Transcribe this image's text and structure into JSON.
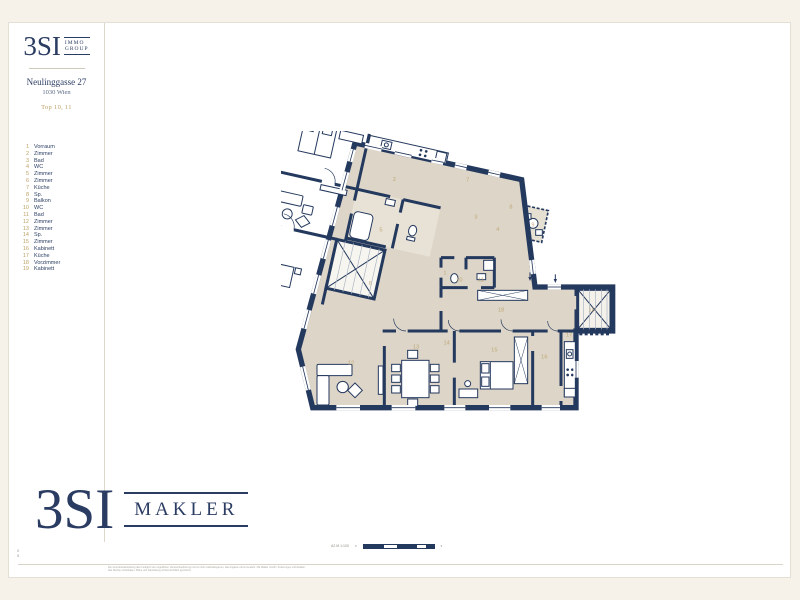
{
  "colors": {
    "navy": "#24395e",
    "gold": "#bda164",
    "beige": "#ddd5c7",
    "cream": "#f6f2e9"
  },
  "header": {
    "logo_text": "3SI",
    "logo_badge_line1": "IMMO",
    "logo_badge_line2": "GROUP",
    "address": "Neulinggasse 27",
    "city": "1030 Wien",
    "unit": "Top 10, 11"
  },
  "legend": {
    "items": [
      {
        "n": "1",
        "label": "Vorraum"
      },
      {
        "n": "2",
        "label": "Zimmer"
      },
      {
        "n": "3",
        "label": "Bad"
      },
      {
        "n": "4",
        "label": "WC"
      },
      {
        "n": "5",
        "label": "Zimmer"
      },
      {
        "n": "6",
        "label": "Zimmer"
      },
      {
        "n": "7",
        "label": "Küche"
      },
      {
        "n": "8",
        "label": "Sp."
      },
      {
        "n": "9",
        "label": "Balkon"
      },
      {
        "n": "10",
        "label": "WC"
      },
      {
        "n": "11",
        "label": "Bad"
      },
      {
        "n": "12",
        "label": "Zimmer"
      },
      {
        "n": "13",
        "label": "Zimmer"
      },
      {
        "n": "14",
        "label": "Sp."
      },
      {
        "n": "15",
        "label": "Zimmer"
      },
      {
        "n": "16",
        "label": "Kabinett"
      },
      {
        "n": "17",
        "label": "Küche"
      },
      {
        "n": "18",
        "label": "Vorzimmer"
      },
      {
        "n": "19",
        "label": "Kabinett"
      }
    ]
  },
  "footer": {
    "logo_text": "3SI",
    "logo_sub": "MAKLER",
    "scale_label": "A2  M 1:100",
    "scale_start": "0",
    "scale_end": "5",
    "fold_mark_top": "0",
    "fold_mark_bottom": "5",
    "disclaimer_line1": "Die Grundrissdarstellung dient lediglich der ungefähren Veranschaulichung und ist nicht maßstabsgetreu, alle Angaben ohne Gewähr. 3SI Makler GmbH, Änderungen vorbehalten.",
    "disclaimer_line2": "Alle Rechte vorbehalten. Pläne und Darstellung urheberrechtlich geschützt."
  }
}
